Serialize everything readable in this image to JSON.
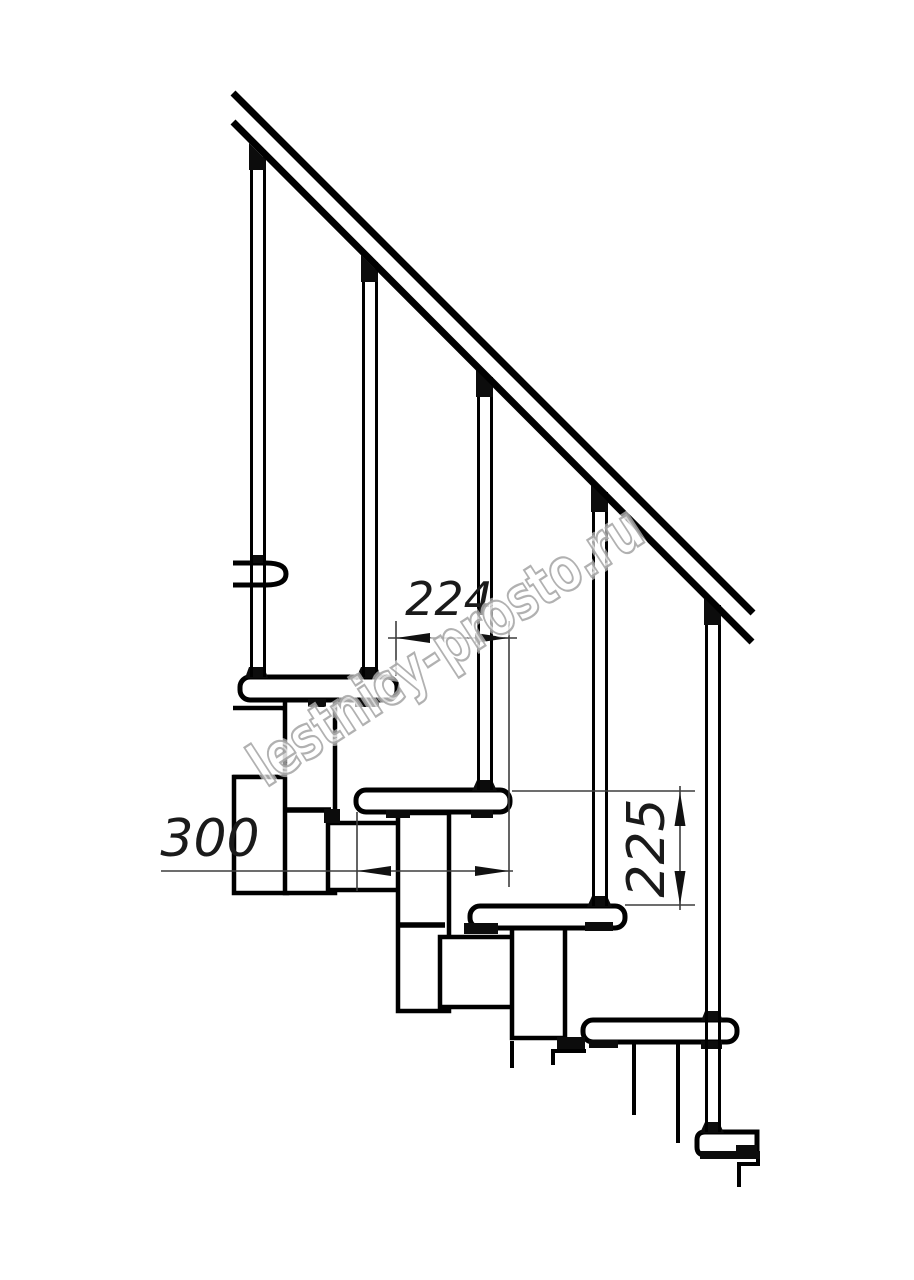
{
  "drawing": {
    "kind_note": "modular staircase side elevation",
    "watermark": {
      "text": "lestnicy-prosto.ru",
      "color": "#a9a9a9"
    },
    "dimensions": {
      "going": {
        "value": "224",
        "orientation": "horizontal"
      },
      "tread_depth": {
        "value": "300",
        "orientation": "horizontal"
      },
      "riser_height": {
        "value": "225",
        "orientation": "vertical"
      }
    },
    "colors": {
      "background": "#ffffff",
      "line": "#000000",
      "dimension_line": "#3d3d3d",
      "dimension_text": "#1a1a1a"
    }
  }
}
